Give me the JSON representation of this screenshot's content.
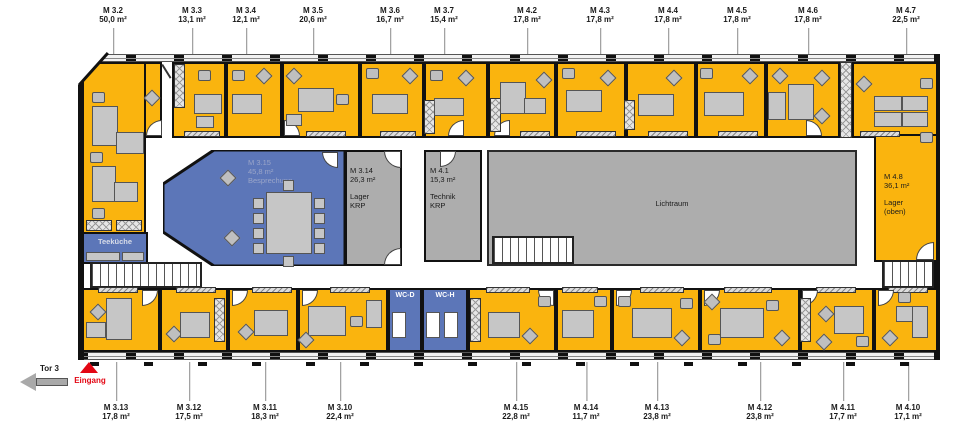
{
  "title": "Floor plan level with rooms M 3.x and M 4.x",
  "rooms_top": [
    {
      "id": "M 3.2",
      "area": "50,0 m²"
    },
    {
      "id": "M 3.3",
      "area": "13,1 m²"
    },
    {
      "id": "M 3.4",
      "area": "12,1 m²"
    },
    {
      "id": "M 3.5",
      "area": "20,6 m²"
    },
    {
      "id": "M 3.6",
      "area": "16,7 m²"
    },
    {
      "id": "M 3.7",
      "area": "15,4 m²"
    },
    {
      "id": "M 4.2",
      "area": "17,8 m²"
    },
    {
      "id": "M 4.3",
      "area": "17,8 m²"
    },
    {
      "id": "M 4.4",
      "area": "17,8 m²"
    },
    {
      "id": "M 4.5",
      "area": "17,8 m²"
    },
    {
      "id": "M 4.6",
      "area": "17,8 m²"
    },
    {
      "id": "M 4.7",
      "area": "22,5 m²"
    }
  ],
  "rooms_bottom": [
    {
      "id": "M 3.13",
      "area": "17,8 m²"
    },
    {
      "id": "M 3.12",
      "area": "17,5 m²"
    },
    {
      "id": "M 3.11",
      "area": "18,3 m²"
    },
    {
      "id": "M 3.10",
      "area": "22,4 m²"
    },
    {
      "id": "M 4.15",
      "area": "22,8 m²"
    },
    {
      "id": "M 4.14",
      "area": "11,7 m²"
    },
    {
      "id": "M 4.13",
      "area": "23,8 m²"
    },
    {
      "id": "M 4.12",
      "area": "23,8 m²"
    },
    {
      "id": "M 4.11",
      "area": "17,7 m²"
    },
    {
      "id": "M 4.10",
      "area": "17,1 m²"
    }
  ],
  "zones": {
    "besprechung": {
      "id": "M 3.15",
      "area": "45,8 m²",
      "name": "Besprechung"
    },
    "lager": {
      "id": "M 3.14",
      "area": "26,3 m²",
      "name": "Lager",
      "org": "KRP"
    },
    "technik": {
      "id": "M 4.1",
      "area": "15,3 m²",
      "name": "Technik",
      "org": "KRP"
    },
    "lichtraum": {
      "name": "Lichtraum"
    },
    "lager_oben": {
      "id": "M 4.8",
      "area": "36,1 m²",
      "name": "Lager",
      "note": "(oben)"
    },
    "teekueche": {
      "name": "Teeküche"
    },
    "wc_d": {
      "name": "WC-D"
    },
    "wc_h": {
      "name": "WC-H"
    }
  },
  "markers": {
    "tor": "Tor 3",
    "eingang": "Eingang"
  },
  "colors": {
    "office_orange": "#FAB40E",
    "meeting_blue": "#5C76B8",
    "storage_gray": "#ADADAD",
    "wall_black": "#111111",
    "entrance_red": "#E30613",
    "leader_gray": "#8A8A8A"
  }
}
